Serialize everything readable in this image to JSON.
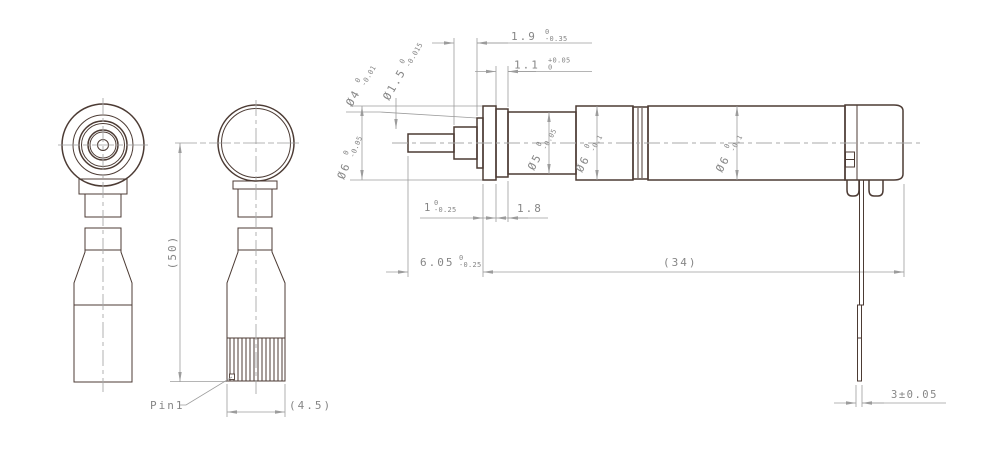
{
  "drawing": {
    "front_view": {
      "overall_height": "(50)",
      "pin_label": "Pin1",
      "flat_width": "(4.5)"
    },
    "side_view": {
      "tip_length": {
        "value": "1.9",
        "tol_up": "0",
        "tol_dn": "-0.35"
      },
      "groove_width": {
        "value": "1.1",
        "tol_up": "+0.05",
        "tol_dn": "0"
      },
      "dia_step": {
        "value": "Ø4",
        "tol_up": "0",
        "tol_dn": "-0.01"
      },
      "dia_tip": {
        "value": "Ø1.5",
        "tol_up": "0",
        "tol_dn": "-0.015"
      },
      "dia_flange": {
        "value": "Ø6",
        "tol_up": "0",
        "tol_dn": "-0.05"
      },
      "dia_body_front": {
        "value": "Ø5",
        "tol_up": "0",
        "tol_dn": "-0.05"
      },
      "dia_body_mid": {
        "value": "Ø6",
        "tol_up": "0",
        "tol_dn": "-0.1"
      },
      "dia_body_rear": {
        "value": "Ø6",
        "tol_up": "0",
        "tol_dn": "-0.1"
      },
      "flange_width": {
        "value": "1",
        "tol_up": "0",
        "tol_dn": "-0.25"
      },
      "neck_length": {
        "value": "1.8"
      },
      "front_length": {
        "value": "6.05",
        "tol_up": "0",
        "tol_dn": "-0.25"
      },
      "body_length": {
        "value": "(34)"
      },
      "terminal_width": {
        "value": "3±0.05"
      }
    },
    "colors": {
      "part_line": "#4c3b34",
      "dim_line": "#9c9c9c",
      "text": "#868686"
    }
  }
}
